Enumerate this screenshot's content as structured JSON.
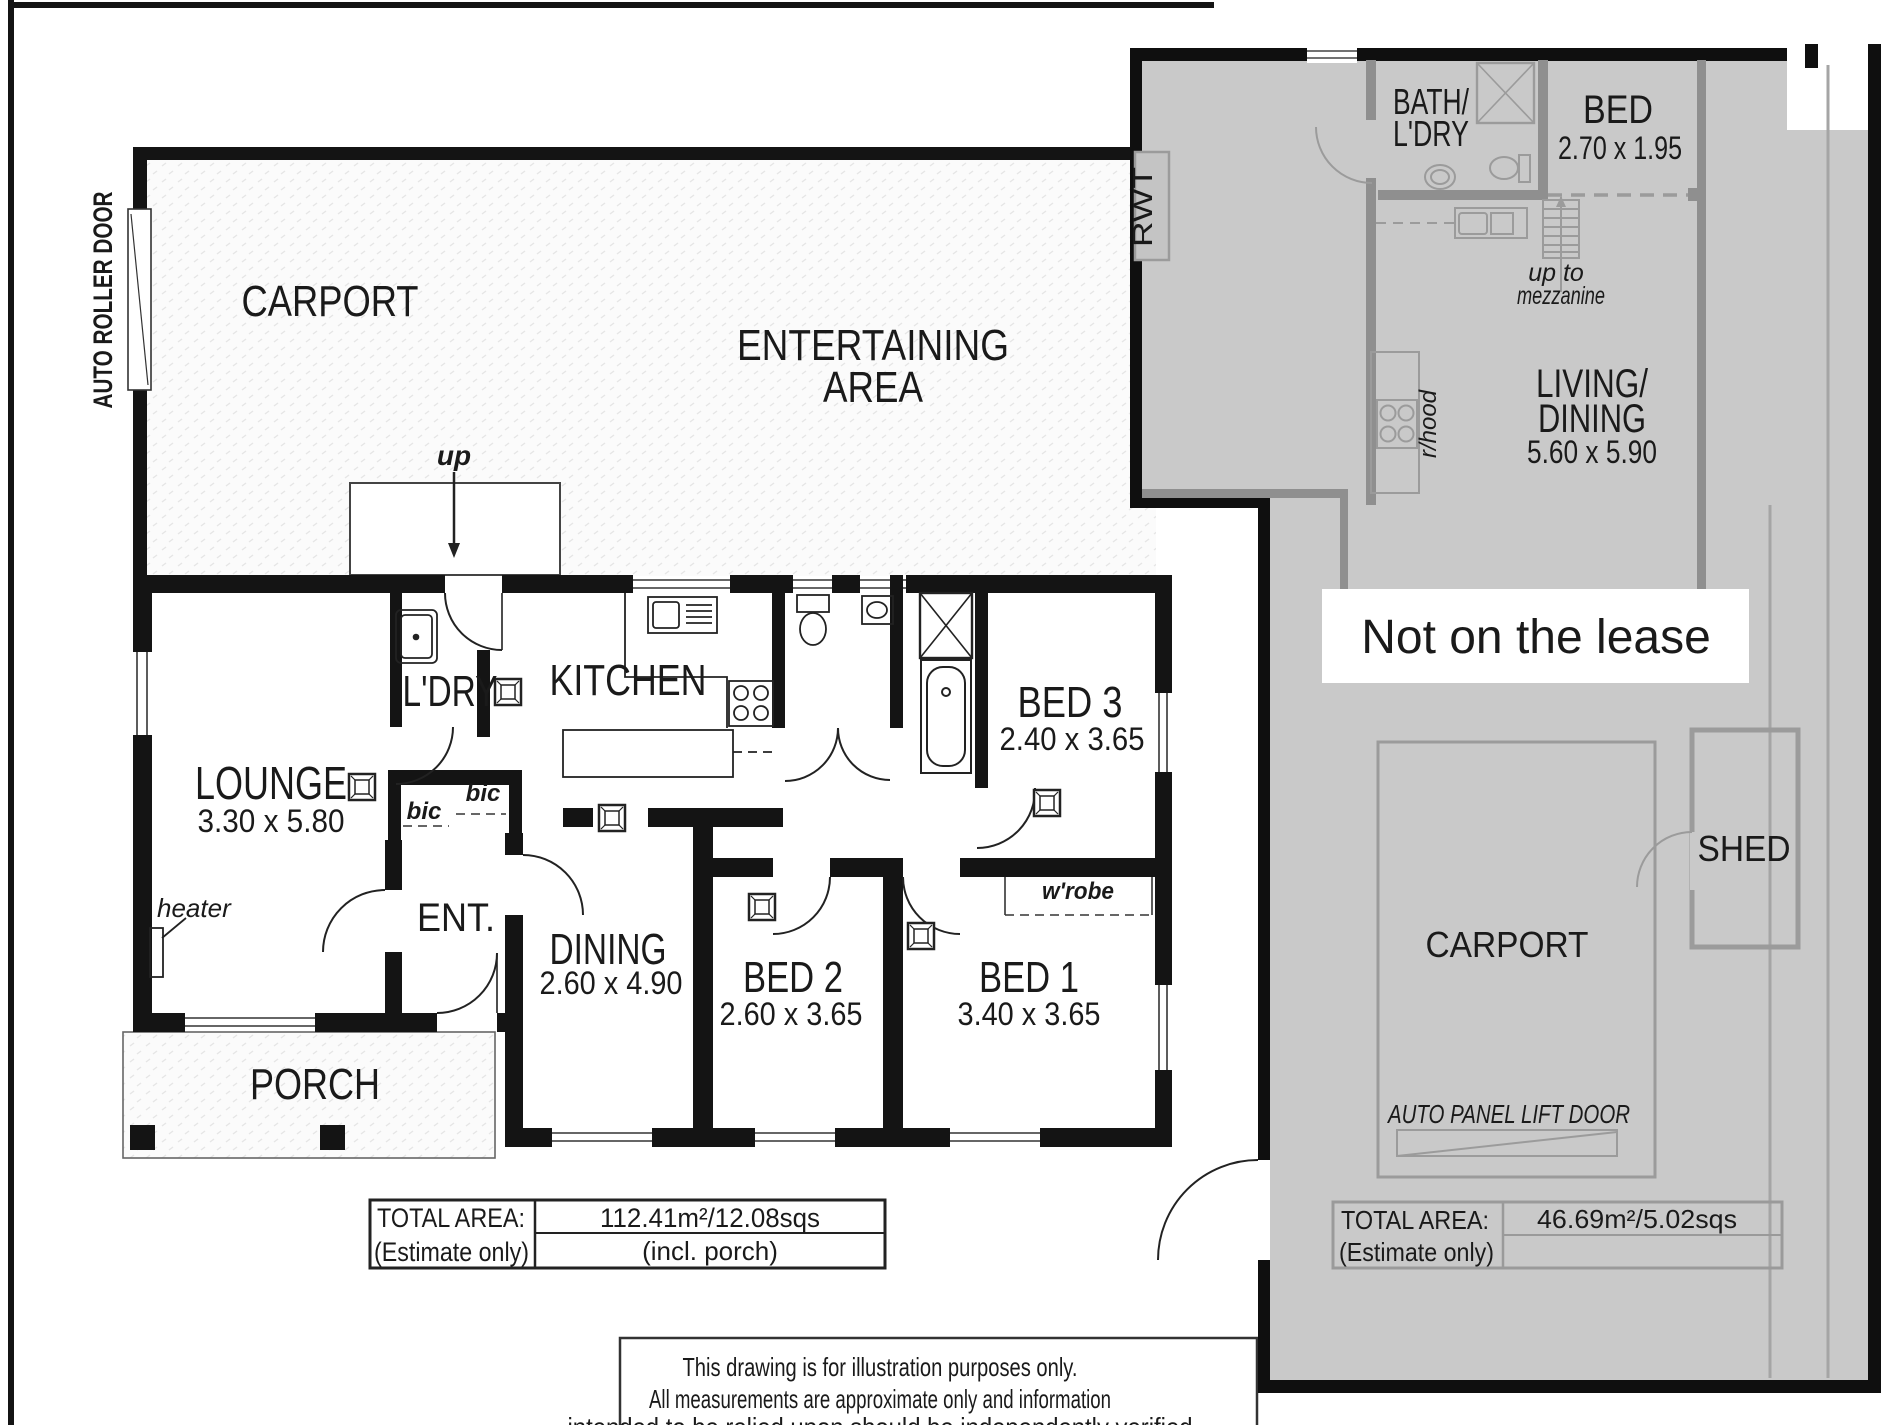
{
  "colors": {
    "plan_line": "#141414",
    "overlay_fill": "#c9c9c9",
    "overlay_line": "#8f8f8f",
    "overlay_text": "#9a9a9a",
    "label_bg": "#ffffff",
    "label_text": "#141414"
  },
  "main_plan": {
    "carport": "CARPORT",
    "entertaining1": "ENTERTAINING",
    "entertaining2": "AREA",
    "auto_roller_door": "AUTO ROLLER DOOR",
    "up": "up",
    "lounge": "LOUNGE",
    "lounge_dims": "3.30 x 5.80",
    "heater": "heater",
    "ldry": "L'DRY",
    "kitchen": "KITCHEN",
    "bic_left": "bic",
    "bic_right": "bic",
    "ent": "ENT.",
    "dining": "DINING",
    "dining_dims": "2.60 x 4.90",
    "bed3": "BED 3",
    "bed3_dims": "2.40 x 3.65",
    "bed2": "BED 2",
    "bed2_dims": "2.60 x 3.65",
    "bed1": "BED 1",
    "bed1_dims": "3.40 x 3.65",
    "wrobe": "w'robe",
    "porch": "PORCH",
    "total_area": {
      "label1": "TOTAL AREA:",
      "label2": "(Estimate only)",
      "value": "112.41m²/12.08sqs",
      "note": "(incl. porch)"
    }
  },
  "overlay_plan": {
    "rwt": "RWT",
    "bath1": "BATH/",
    "bath2": "L'DRY",
    "bed": "BED",
    "bed_dims": "2.70 x 1.95",
    "upto1": "up to",
    "upto2": "mezzanine",
    "rhood": "r/hood",
    "living1": "LIVING/",
    "living2": "DINING",
    "living_dims": "5.60 x 5.90",
    "carport": "CARPORT",
    "shed": "SHED",
    "auto_panel": "AUTO PANEL LIFT DOOR",
    "total_area": {
      "label1": "TOTAL AREA:",
      "label2": "(Estimate only)",
      "value": "46.69m²/5.02sqs"
    }
  },
  "annotation": {
    "not_on_lease": "Not on the lease"
  },
  "disclaimer": {
    "line1": "This drawing is for illustration purposes only.",
    "line2": "All measurements are approximate only and information",
    "line3": "intended to be relied upon should be independently verified"
  }
}
